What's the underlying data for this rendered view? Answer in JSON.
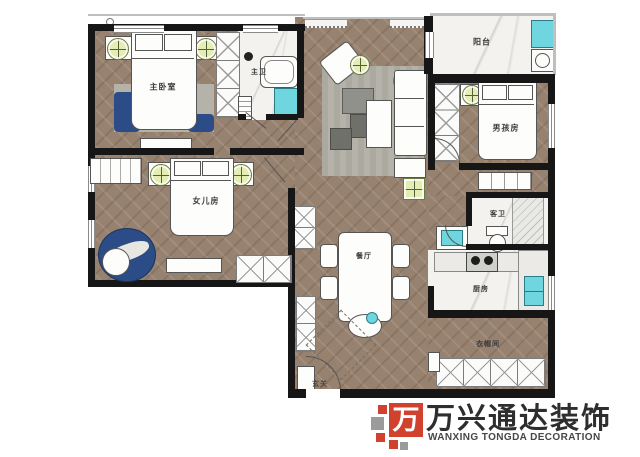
{
  "rooms": {
    "master_bedroom": {
      "label": "主卧室"
    },
    "master_bath": {
      "label": "主卫"
    },
    "balcony": {
      "label": "阳台"
    },
    "boys_room": {
      "label": "男孩房"
    },
    "daughters_room": {
      "label": "女儿房"
    },
    "guest_bath": {
      "label": "客卫"
    },
    "kitchen": {
      "label": "厨房"
    },
    "dining": {
      "label": "餐厅"
    },
    "cloakroom": {
      "label": "衣帽间"
    },
    "entry": {
      "label": "玄关"
    }
  },
  "logo": {
    "name_cn": "万兴通达装饰",
    "name_en": "WANXING TONGDA DECORATION",
    "mark_char": "万",
    "red": "#d0422d",
    "gray": "#9b9b9b"
  },
  "colors": {
    "wall": "#161616",
    "wood_floor": "#97816f",
    "tile_floor": "#f3f2ef",
    "fixture_cyan": "#6fd6df",
    "rug_navy": "#2b4c86",
    "rug_gray": "#b5b2a9",
    "plant_green": "#e4edb4"
  }
}
